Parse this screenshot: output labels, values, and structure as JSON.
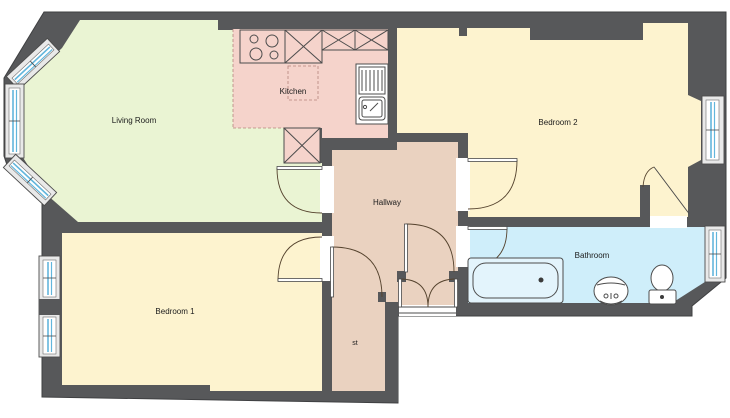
{
  "plan": {
    "title": "Flat floor plan",
    "rooms": [
      {
        "id": "living-room",
        "label": "Living Room",
        "color": "#eaf4d3"
      },
      {
        "id": "kitchen",
        "label": "Kitchen",
        "color": "#f5d3cb"
      },
      {
        "id": "bedroom-2",
        "label": "Bedroom 2",
        "color": "#fdf3cf"
      },
      {
        "id": "bedroom-1",
        "label": "Bedroom 1",
        "color": "#fdf3cf"
      },
      {
        "id": "hallway",
        "label": "Hallway",
        "color": "#ead2c0"
      },
      {
        "id": "store",
        "label": "st",
        "color": "#ead2c0"
      },
      {
        "id": "bathroom",
        "label": "Bathroom",
        "color": "#cfeefa"
      }
    ],
    "colors": {
      "wall": "#57585a",
      "window_glass": "#62b6dc",
      "door_line": "#55432e",
      "tub_fill": "#e3f4fc",
      "cabinet_fill": "#f5d3cb"
    },
    "fixtures": [
      "hob-4-ring",
      "base-cabinet-x",
      "base-cabinet-x-double",
      "kitchen-sink-with-drainer",
      "appliance-under-counter",
      "bathtub",
      "pedestal-basin",
      "toilet"
    ],
    "windows": [
      "bay-window-3-panel",
      "bedroom1-double-window",
      "bedroom2-window",
      "bathroom-window"
    ],
    "doors": [
      "living-room-door",
      "bedroom1-door",
      "bedroom2-door",
      "bathroom-door",
      "store-door",
      "inner-hall-door",
      "entrance-double-door",
      "bedroom2-closet-door"
    ]
  }
}
